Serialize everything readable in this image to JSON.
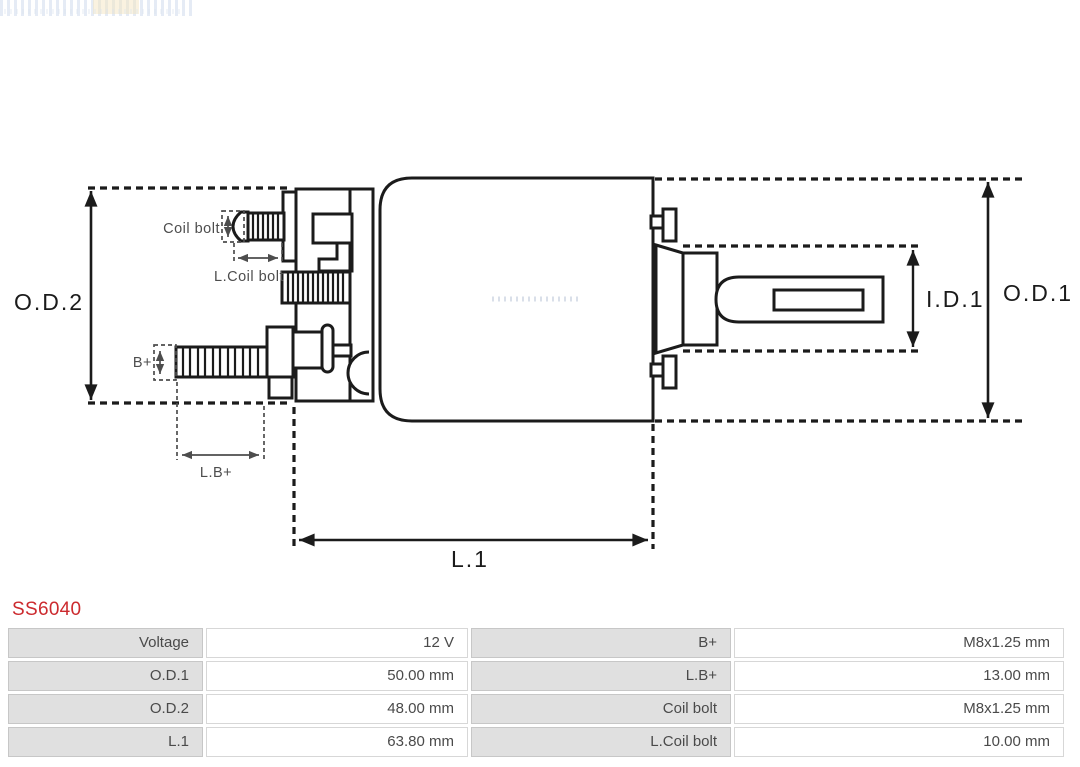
{
  "part": {
    "code": "SS6040",
    "code_color": "#CC2A2E"
  },
  "diagram": {
    "labels": {
      "od2": "O.D.2",
      "od1": "O.D.1",
      "id1": "I.D.1",
      "l1": "L.1",
      "coil_bolt": "Coil bolt",
      "l_coil_bolt": "L.Coil bolt",
      "b_plus": "B+",
      "l_b_plus": "L.B+"
    },
    "ink_color": "#1b1b1b",
    "dim_gray_color": "#4d4d4d"
  },
  "spec_table": {
    "rows": [
      {
        "c1": "Voltage",
        "c2": "12 V",
        "c3": "B+",
        "c4": "M8x1.25 mm"
      },
      {
        "c1": "O.D.1",
        "c2": "50.00 mm",
        "c3": "L.B+",
        "c4": "13.00 mm"
      },
      {
        "c1": "O.D.2",
        "c2": "48.00 mm",
        "c3": "Coil bolt",
        "c4": "M8x1.25 mm"
      },
      {
        "c1": "L.1",
        "c2": "63.80 mm",
        "c3": "L.Coil bolt",
        "c4": "10.00 mm"
      }
    ]
  }
}
